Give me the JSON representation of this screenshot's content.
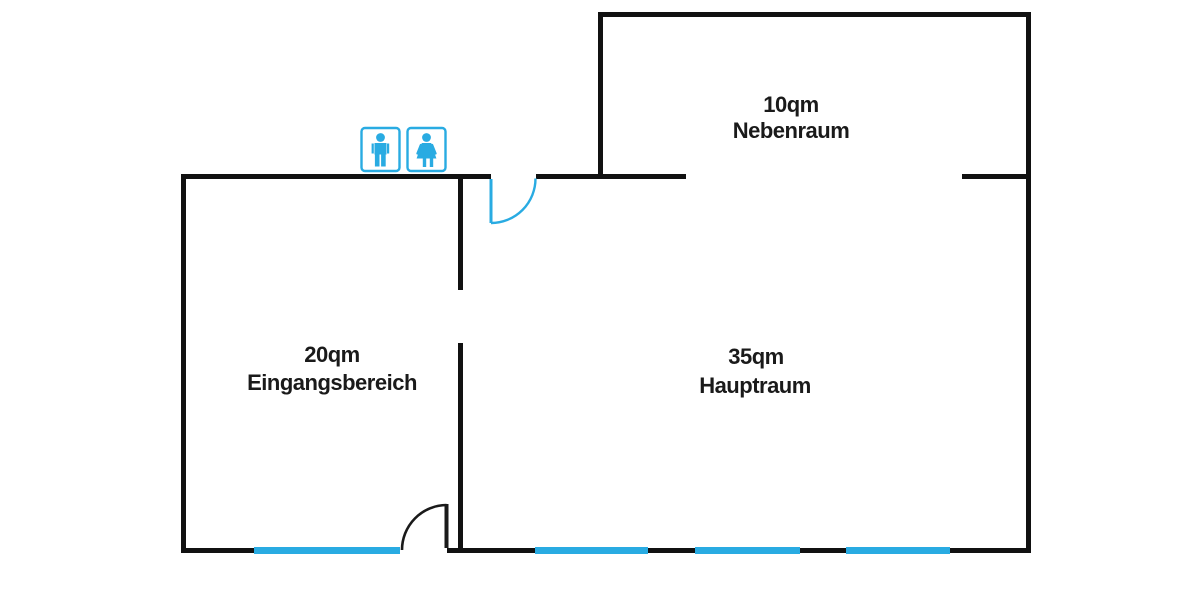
{
  "colors": {
    "wall": "#111111",
    "accent_blue": "#29ABE2",
    "text": "#1a1a1a",
    "background": "#ffffff"
  },
  "rooms": [
    {
      "area": "10qm",
      "name": "Nebenraum"
    },
    {
      "area": "20qm",
      "name": "Eingangsbereich"
    },
    {
      "area": "35qm",
      "name": "Hauptraum"
    }
  ],
  "icons": [
    {
      "name": "male-restroom-icon"
    },
    {
      "name": "female-restroom-icon"
    }
  ],
  "features": {
    "windows": [
      "eingangsbereich-window",
      "hauptraum-window-1",
      "hauptraum-window-2",
      "hauptraum-window-3"
    ],
    "doors": [
      "interior-door-top",
      "entrance-door-bottom"
    ],
    "openings": [
      "nebenraum-passage",
      "interior-passage"
    ]
  }
}
